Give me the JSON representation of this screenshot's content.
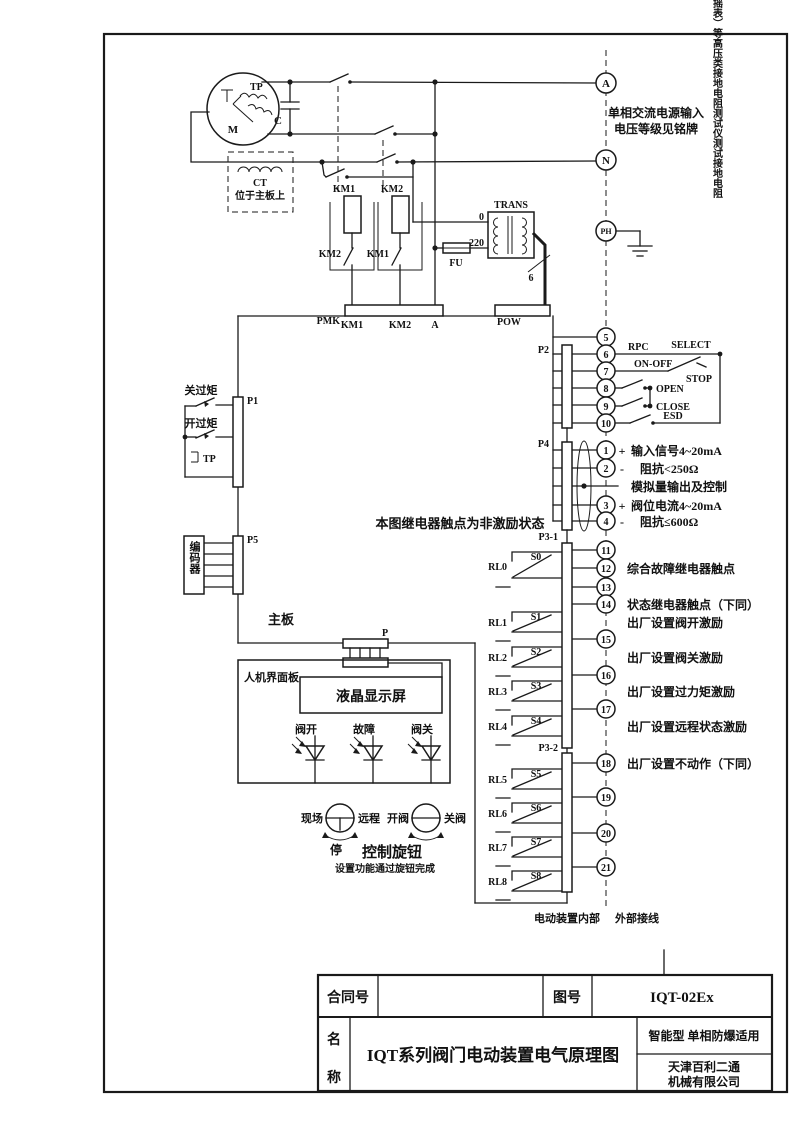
{
  "doc": {
    "warning_vertical": "禁止使用兆欧表（摇表）等高压类接地电阻测试仪测试接地电阻",
    "power_note1": "单相交流电源输入",
    "power_note2": "电压等级见铭牌",
    "relay_note": "本图继电器触点为非激励状态",
    "internal_label": "电动装置内部",
    "external_label": "外部接线",
    "mainboard": "主板"
  },
  "motor": {
    "tp": "TP",
    "m": "M",
    "c": "C",
    "ct": "CT",
    "ct_note": "位于主板上"
  },
  "supply": {
    "a": "A",
    "n": "N",
    "ph": "PH"
  },
  "contactor": {
    "km1": "KM1",
    "km2": "KM2",
    "km1_aux": "KM2",
    "km2_aux": "KM1"
  },
  "conn": {
    "pmk": "PMK",
    "pmk_km1": "KM1",
    "pmk_km2": "KM2",
    "pmk_a": "A",
    "pow": "POW",
    "p": "P",
    "p1": "P1",
    "p2": "P2",
    "p4": "P4",
    "p31": "P3-1",
    "p32": "P3-2",
    "p5": "P5"
  },
  "trans": {
    "name": "TRANS",
    "fu": "FU",
    "tap0": "0",
    "tap220": "220",
    "wires": "6"
  },
  "p2": {
    "t5": "5",
    "t6": "6",
    "t7": "7",
    "t8": "8",
    "t9": "9",
    "t10": "10",
    "rpc": "RPC",
    "select": "SELECT",
    "onoff": "ON-OFF",
    "stop": "STOP",
    "open": "OPEN",
    "close": "CLOSE",
    "esd": "ESD"
  },
  "p4": {
    "t1": "1",
    "t2": "2",
    "t3": "3",
    "t4": "4",
    "plus1": "+",
    "minus1": "-",
    "plus2": "+",
    "minus2": "-",
    "l1": "输入信号4~20mA",
    "l2": "阻抗<250Ω",
    "l3": "模拟量输出及控制",
    "l4": "阀位电流4~20mA",
    "l5": "阻抗≤600Ω"
  },
  "p3": {
    "t11": "11",
    "t12": "12",
    "t13": "13",
    "t14": "14",
    "t15": "15",
    "t16": "16",
    "t17": "17",
    "t18": "18",
    "t19": "19",
    "t20": "20",
    "t21": "21",
    "l12": "综合故障继电器触点",
    "l14": "状态继电器触点（下同）",
    "l_rl1": "出厂设置阀开激励",
    "l_rl2": "出厂设置阀关激励",
    "l_rl3": "出厂设置过力矩激励",
    "l_rl4": "出厂设置远程状态激励",
    "l18": "出厂设置不动作（下同）"
  },
  "relays": {
    "rl0": "RL0",
    "s0": "S0",
    "rl1": "RL1",
    "s1": "S1",
    "rl2": "RL2",
    "s2": "S2",
    "rl3": "RL3",
    "s3": "S3",
    "rl4": "RL4",
    "s4": "S4",
    "rl5": "RL5",
    "s5": "S5",
    "rl6": "RL6",
    "s6": "S6",
    "rl7": "RL7",
    "s7": "S7",
    "rl8": "RL8",
    "s8": "S8"
  },
  "left": {
    "close_torque": "关过矩",
    "open_torque": "开过矩",
    "tp": "TP",
    "encoder": "编码器"
  },
  "hmi": {
    "panel": "人机界面板",
    "lcd": "液晶显示屏",
    "led_open": "阀开",
    "led_fault": "故障",
    "led_close": "阀关",
    "local": "现场",
    "remote": "远程",
    "stop": "停",
    "open": "开阀",
    "close": "关阀",
    "knob": "控制旋钮",
    "knob_note": "设置功能通过旋钮完成"
  },
  "titleblock": {
    "contract": "合同号",
    "contract_value": "",
    "drawing_no": "图号",
    "drawing_value": "IQT-02Ex",
    "name1": "名",
    "name2": "称",
    "title": "IQT系列阀门电动装置电气原理图",
    "type": "智能型  单相防爆适用",
    "company1": "天津百利二通",
    "company2": "机械有限公司"
  }
}
